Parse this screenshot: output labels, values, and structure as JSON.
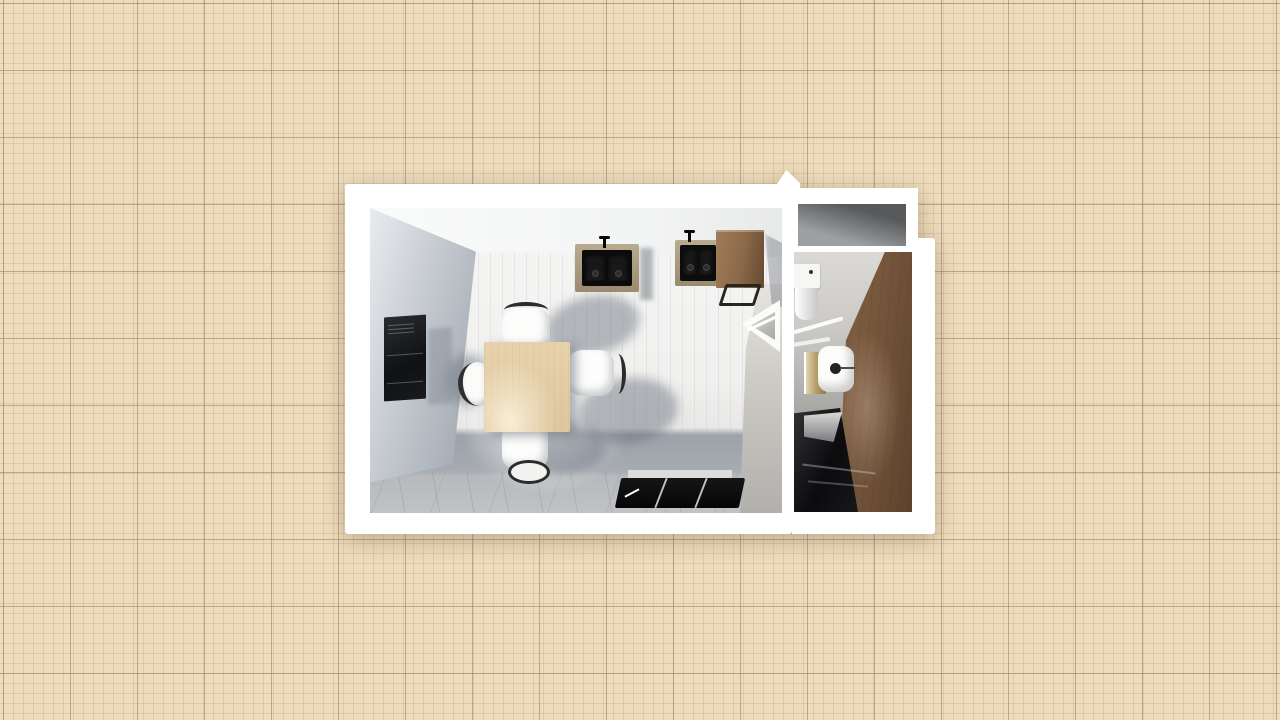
{
  "app": {
    "name": "floor-plan-3d-top-view"
  },
  "palette": {
    "paper": "#eedcbd",
    "grid_major": "#8f7c668c",
    "grid_minor": "#b0926e40",
    "outline_white": "#ffffff",
    "wall_gray": "#99a0a9",
    "floor_light": "#f6f6f4",
    "floor_shadow": "#9da3aa",
    "floor_marble": "#c0c2c5",
    "divider_plaster": "#cfccc6",
    "niche_dark": "#57595b",
    "niche_light": "#9da0a2",
    "table_wood": "#e8d2ac",
    "cabinet_wood": "#8a6848",
    "bathroom_wood": "#7c5c40",
    "appliance_dark": "#101114",
    "sink_frame_wood": "#9a8b70",
    "ceramic_white": "#fdfdfc",
    "toilet_tank_tan": "#ab9560",
    "chair_trim_dark": "#2b2b2b"
  },
  "scene": {
    "rooms": [
      {
        "id": "living-dining-room",
        "label": "Living / dining room"
      },
      {
        "id": "bathroom",
        "label": "Bathroom"
      },
      {
        "id": "storage-niche",
        "label": "Storage niche"
      }
    ],
    "furniture": [
      {
        "id": "wall-tv-panel",
        "label": "Wall-mounted TV panel",
        "room": "living-dining-room"
      },
      {
        "id": "double-sink-unit",
        "label": "Wall double sink unit",
        "room": "living-dining-room"
      },
      {
        "id": "wall-sink-unit",
        "label": "Wall sink unit",
        "room": "living-dining-room"
      },
      {
        "id": "wooden-cabinet",
        "label": "Wooden cabinet",
        "room": "living-dining-room"
      },
      {
        "id": "dining-table",
        "label": "Dining table",
        "room": "living-dining-room"
      },
      {
        "id": "dining-chair-north",
        "label": "Dining chair (top)",
        "room": "living-dining-room"
      },
      {
        "id": "dining-chair-east",
        "label": "Dining chair (right)",
        "room": "living-dining-room"
      },
      {
        "id": "dining-chair-south",
        "label": "Dining chair (bottom)",
        "room": "living-dining-room"
      },
      {
        "id": "dining-chair-west",
        "label": "Dining chair (left)",
        "room": "living-dining-room"
      },
      {
        "id": "floor-tv",
        "label": "Flat TV near south wall",
        "room": "living-dining-room"
      },
      {
        "id": "corner-shelf",
        "label": "Corner wall shelf",
        "room": "living-dining-room"
      },
      {
        "id": "washbasin",
        "label": "Washbasin",
        "room": "bathroom"
      },
      {
        "id": "toilet",
        "label": "Toilet",
        "room": "bathroom"
      },
      {
        "id": "dark-vanity",
        "label": "Dark vanity cabinet",
        "room": "bathroom"
      }
    ]
  }
}
